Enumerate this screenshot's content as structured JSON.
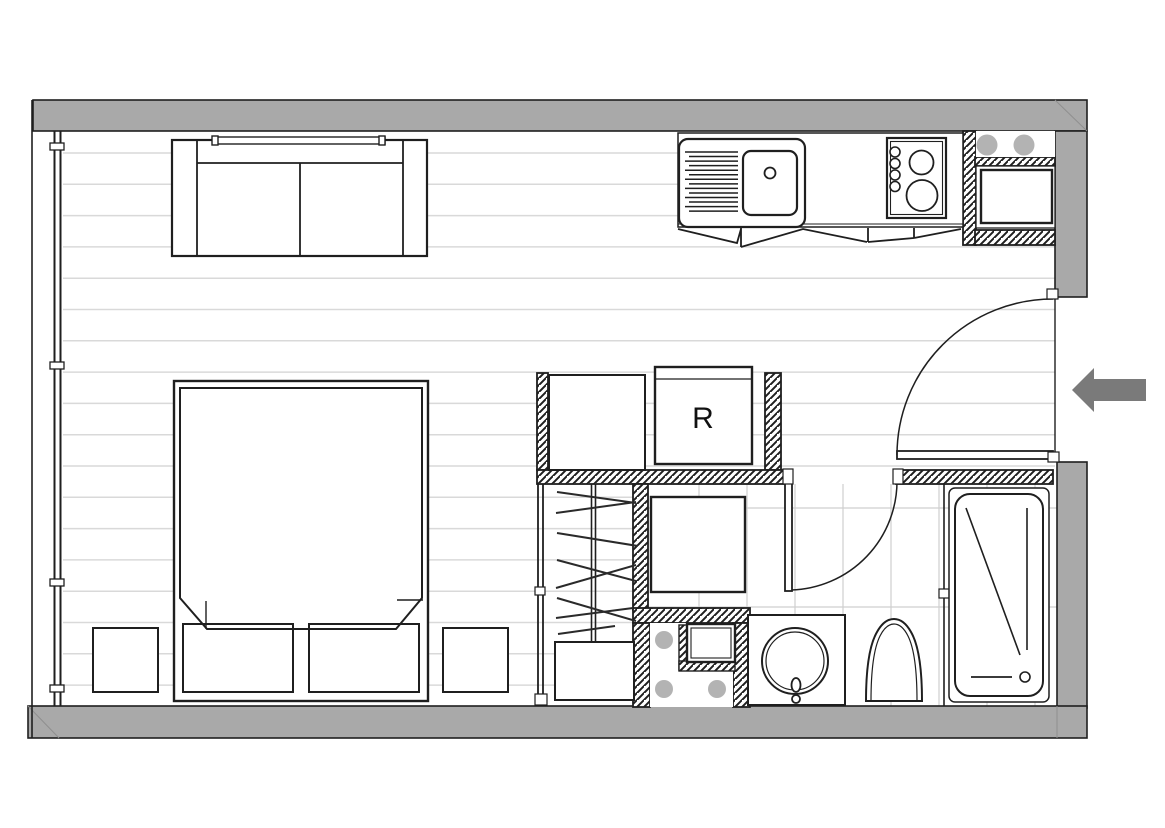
{
  "labels": {
    "refrigerator": "R"
  },
  "colors": {
    "wall": "#a9a9a9",
    "arrow": "#7a7a7a",
    "appliance_dot": "#b3b3b3",
    "shaft_dot": "#b3b3b3",
    "line": "#1f1f1f",
    "plank_line": "#d9d9d9",
    "tile_line": "#cfcfcf",
    "miter_line": "#8f8f8f"
  },
  "fixtures": {
    "sofa": "sofa",
    "wall_shelf": "wall-shelf",
    "bed": "double-bed",
    "pillows": "pillows",
    "nightstand": "nightstand",
    "wardrobe": "wardrobe-with-hangers",
    "cabinet": "cabinet",
    "refrigerator": "refrigerator",
    "kitchen_sink": "kitchen-sink-with-drainer",
    "hob": "four-ring-hob",
    "oven": "built-in-appliance",
    "service_shaft": "service-shaft",
    "shower": "shower-tray",
    "washbasin": "round-washbasin",
    "toilet": "toilet",
    "bathtub": "bathtub",
    "entry_door": "entry-door",
    "bathroom_door": "bathroom-door",
    "window": "full-height-window",
    "entry_arrow": "entry-arrow"
  }
}
